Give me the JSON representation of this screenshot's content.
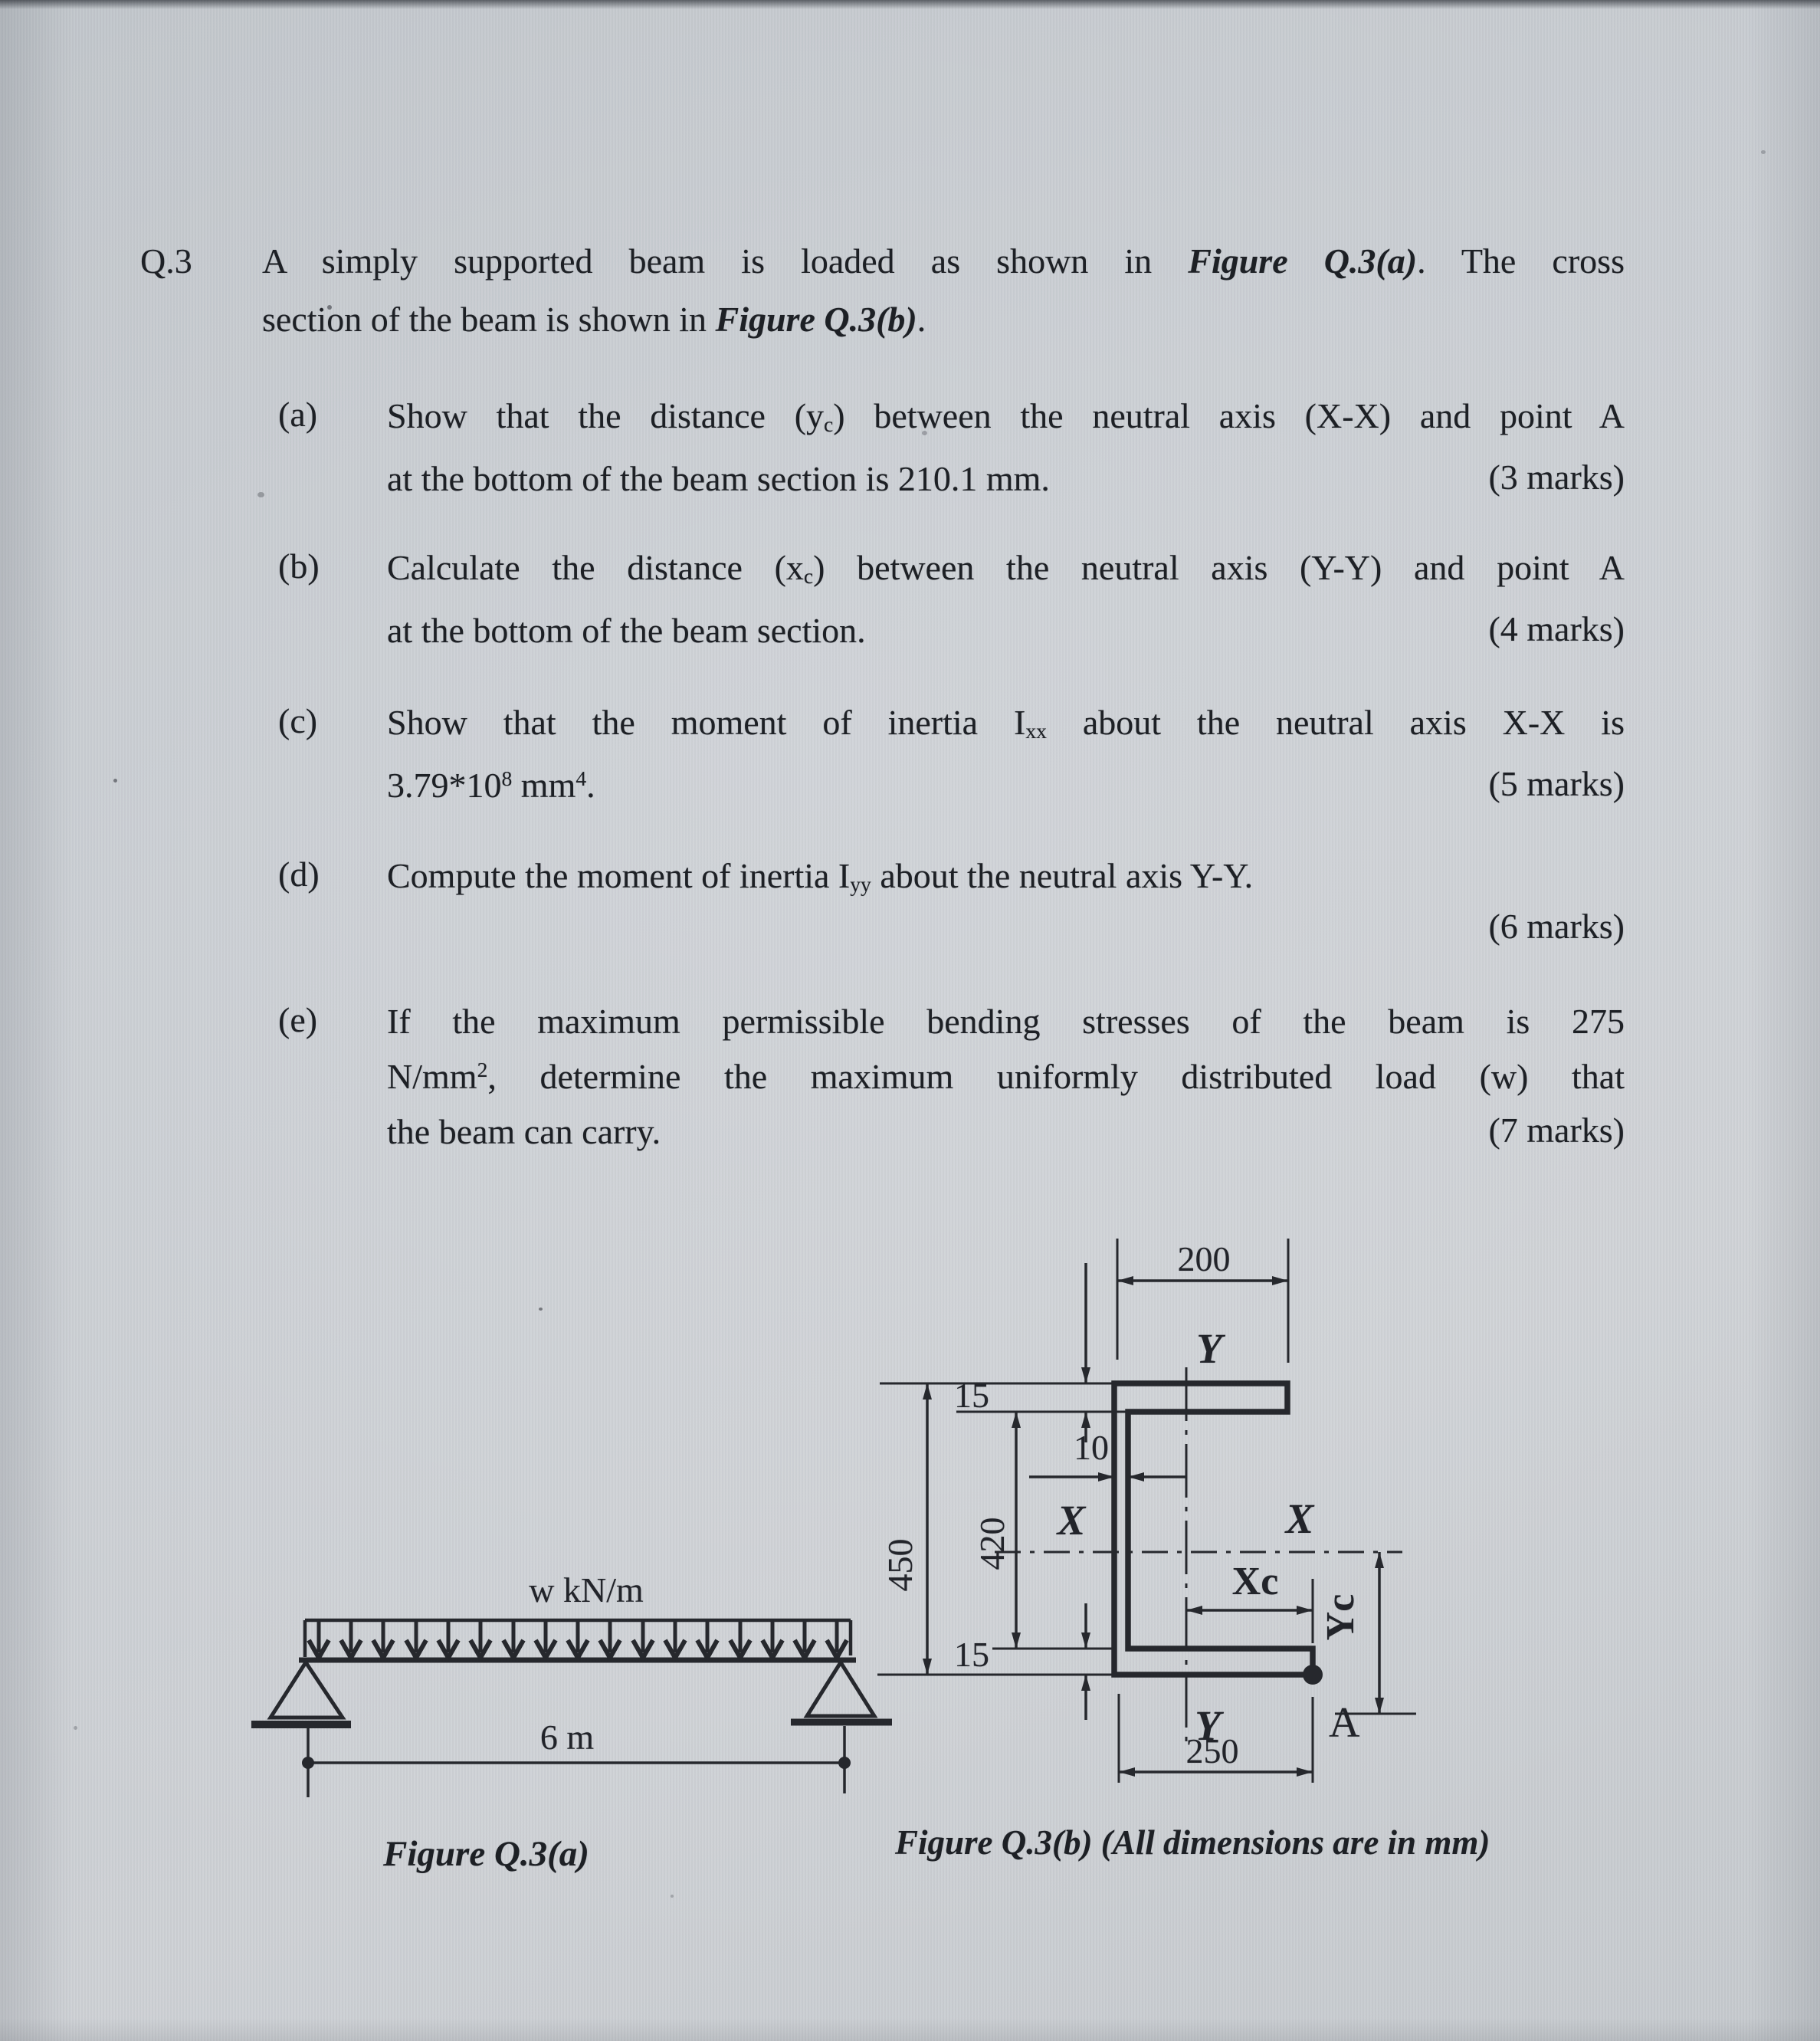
{
  "question": {
    "number": "Q.3",
    "intro": {
      "l1a": "A simply supported beam is loaded as shown in ",
      "l1b": "Figure Q.3(a)",
      "l1c": ". The cross",
      "l2a": "section of the beam is shown in ",
      "l2b": "Figure Q.3(b)",
      "l2c": "."
    },
    "items": [
      {
        "label": "(a)",
        "l1a": "Show that the distance (y",
        "l1sub": "c",
        "l1b": ") between the neutral axis (X-X) and point A",
        "l2": "at the bottom of the beam section is 210.1 mm.",
        "marks": "(3 marks)"
      },
      {
        "label": "(b)",
        "l1a": "Calculate the distance (x",
        "l1sub": "c",
        "l1b": ") between the neutral axis (Y-Y) and point A",
        "l2": "at the bottom of the beam section.",
        "marks": "(4 marks)"
      },
      {
        "label": "(c)",
        "l1a": "Show that the moment of inertia I",
        "l1sub": "xx",
        "l1b": " about the neutral axis X-X is",
        "l2a": "3.79*10",
        "l2sup": "8",
        "l2b": " mm",
        "l2sup2": "4",
        "l2c": ".",
        "marks": "(5 marks)"
      },
      {
        "label": "(d)",
        "l1a": "Compute the moment of inertia I",
        "l1sub": "yy",
        "l1b": " about the neutral axis Y-Y.",
        "marks": "(6 marks)"
      },
      {
        "label": "(e)",
        "l1": "If the maximum permissible bending stresses of the beam is 275",
        "l2a": "N/mm",
        "l2sup": "2",
        "l2b": ", determine the maximum uniformly distributed load (w) that",
        "l3": "the beam can carry.",
        "marks": "(7 marks)"
      }
    ]
  },
  "figure_a": {
    "load_label": "w kN/m",
    "span_label": "6 m",
    "caption": "Figure Q.3(a)"
  },
  "figure_b": {
    "caption": "Figure Q.3(b) (All dimensions are in mm)",
    "dims": {
      "top_width": "200",
      "flange_top": "15",
      "web": "10",
      "height": "450",
      "inner_height": "420",
      "flange_bottom": "15",
      "bottom_width": "250"
    },
    "labels": {
      "axis_y_top": "Y",
      "axis_y_bottom": "Y",
      "axis_x_left": "X",
      "axis_x_right": "X",
      "xc": "Xc",
      "yc": "Yc",
      "point": "A"
    }
  },
  "colors": {
    "paper": "#c8ccd1",
    "ink": "#26282d"
  }
}
